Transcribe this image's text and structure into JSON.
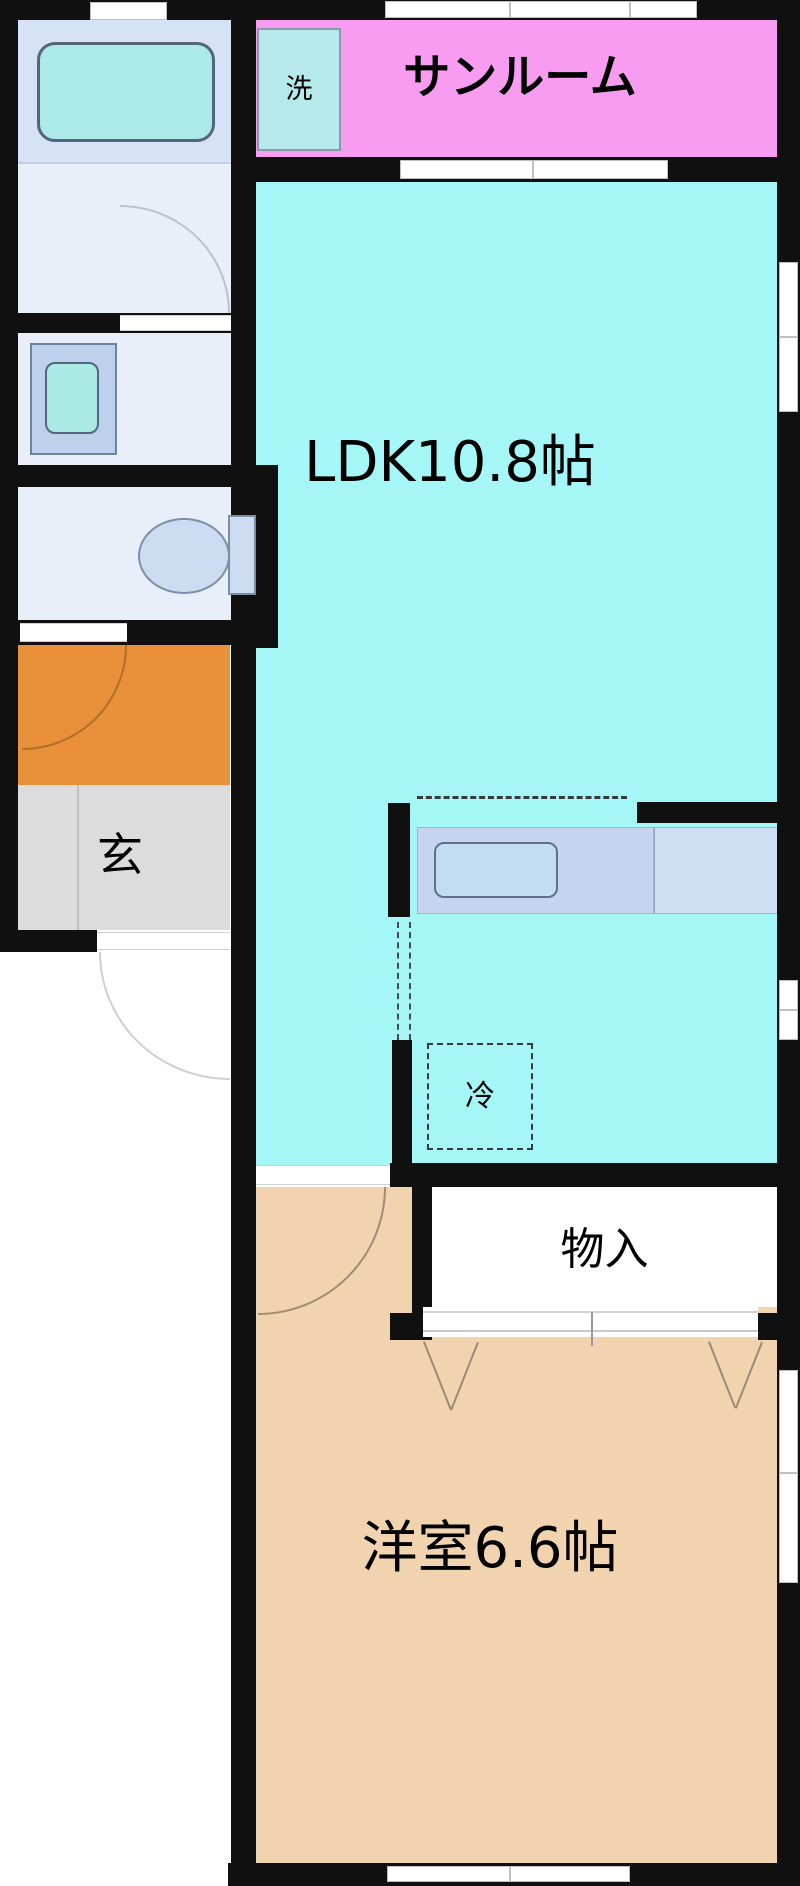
{
  "floor_plan": {
    "rooms": {
      "ldk": {
        "label": "LDK10.8帖",
        "color": "#a5f6f6"
      },
      "western_room": {
        "label": "洋室6.6帖",
        "color": "#f1d3af"
      },
      "sunroom": {
        "label": "サンルーム",
        "color": "#f79cf0"
      },
      "entrance": {
        "label": "玄",
        "color": "#dcdcdc"
      },
      "entrance_hall": {
        "color": "#e8913a"
      },
      "storage": {
        "label": "物入",
        "color": "#ffffff"
      },
      "bathroom": {
        "color": "#d6e3f6"
      },
      "bathroom_lower": {
        "color": "#e9eff9"
      },
      "washroom": {
        "color": "#e9eff9"
      },
      "toilet_room": {
        "color": "#e9eff9"
      }
    },
    "fixtures": {
      "washing_machine": {
        "label": "洗"
      },
      "refrigerator": {
        "label": "冷"
      }
    },
    "palette": {
      "wall": "#101010",
      "window": "#ffffff",
      "bathtub": "#abeae7",
      "basin_outer": "#bdd1ed",
      "basin_inner": "#abe9e5",
      "toilet_fill": "#ccdcf2",
      "counter": "#c7d4ef",
      "counter_light": "#cfddf5",
      "kitchen_sink": "#c2dcf2",
      "washer_box": "#b5e9ec"
    }
  }
}
